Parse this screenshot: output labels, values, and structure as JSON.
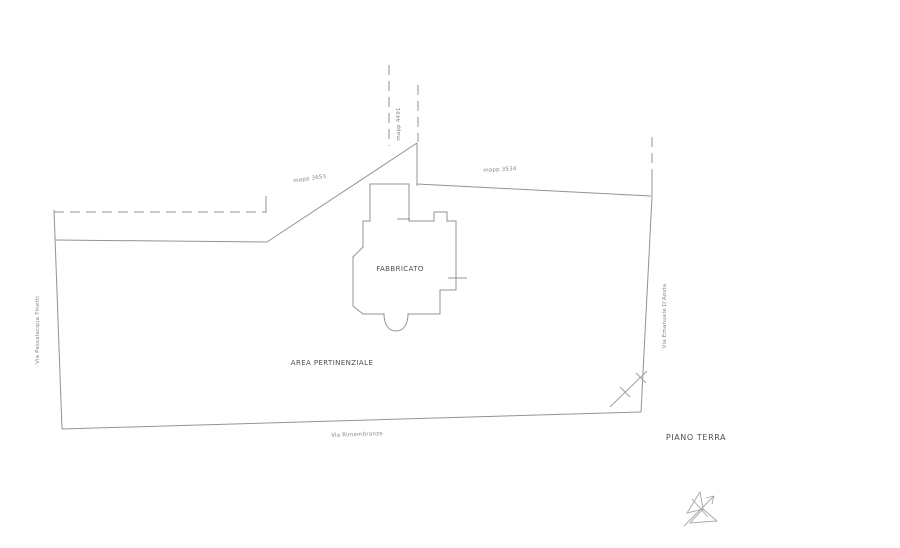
{
  "page": {
    "background": "#ffffff"
  },
  "drawing": {
    "floor_label": "PIANO TERRA",
    "building_label": "FABBRICATO",
    "area_label": "AREA PERTINENZIALE",
    "parcels": {
      "left": "mapp 3653",
      "top": "mapp 4491",
      "right": "mapp 3534"
    },
    "streets": {
      "left": "Via Passalacqua Tinetti",
      "bottom": "Via Rimembranze",
      "right": "Via Emanuele D'Aosta"
    },
    "icons": {
      "north_arrow": "north-arrow-icon"
    },
    "colors": {
      "line": "#8f939a",
      "label_dark": "#4b4f55",
      "label_light": "#82868d",
      "background": "#ffffff"
    }
  }
}
